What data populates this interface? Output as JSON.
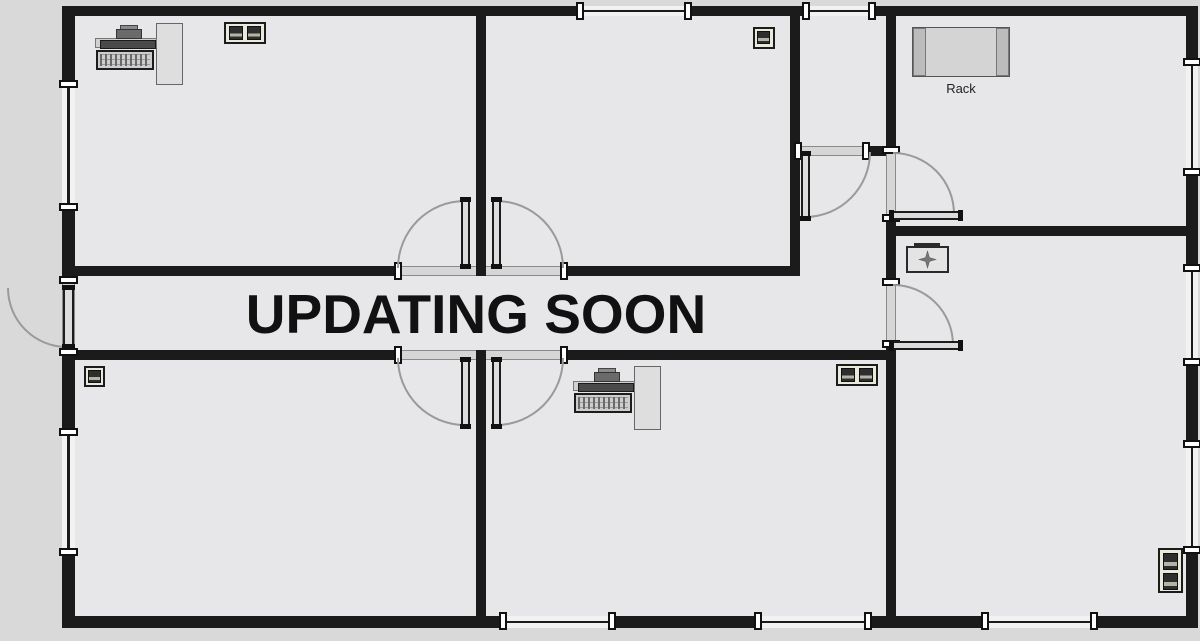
{
  "banner": {
    "text": "UPDATING SOON"
  },
  "rack_label": "Rack",
  "colors": {
    "canvas_bg": "#d9d9d9",
    "floor": "#e7e7e9",
    "wall": "#1b1b1b",
    "window_band": "#f2f2f2",
    "door_leaf": "#dcdcdc",
    "door_opening": "#d6d6d6",
    "swing_arc": "#9a9a9a",
    "banner_text": "#111111"
  },
  "fixtures": [
    {
      "icon": "workstation-icon",
      "location": "top-left-room"
    },
    {
      "icon": "dual-network-port-icon",
      "location": "top-left-room"
    },
    {
      "icon": "network-port-icon",
      "location": "top-middle-room"
    },
    {
      "icon": "rack-icon",
      "location": "top-right-room",
      "label": "Rack"
    },
    {
      "icon": "first-aid-box-icon",
      "location": "right-room"
    },
    {
      "icon": "network-port-icon",
      "location": "bottom-left-room"
    },
    {
      "icon": "workstation-icon",
      "location": "bottom-middle-room"
    },
    {
      "icon": "dual-network-port-icon",
      "location": "bottom-middle-room"
    },
    {
      "icon": "double-outlet-icon",
      "location": "right-room"
    }
  ]
}
